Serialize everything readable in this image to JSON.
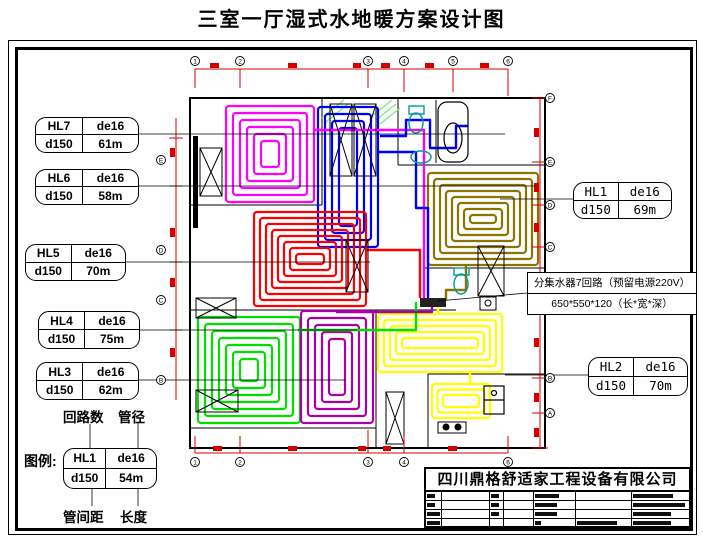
{
  "title": "三室一厅湿式水地暖方案设计图",
  "company": "四川鼎格舒适家工程设备有限公司",
  "labels": {
    "hl7": {
      "circuit": "HL7",
      "pipe": "de16",
      "spacing": "d150",
      "length": "61m"
    },
    "hl6": {
      "circuit": "HL6",
      "pipe": "de16",
      "spacing": "d150",
      "length": "58m"
    },
    "hl5": {
      "circuit": "HL5",
      "pipe": "de16",
      "spacing": "d150",
      "length": "70m"
    },
    "hl4": {
      "circuit": "HL4",
      "pipe": "de16",
      "spacing": "d150",
      "length": "75m"
    },
    "hl3": {
      "circuit": "HL3",
      "pipe": "de16",
      "spacing": "d150",
      "length": "62m"
    },
    "hl1": {
      "circuit": "HL1",
      "pipe": "de16",
      "spacing": "d150",
      "length": "69m"
    },
    "hl2": {
      "circuit": "HL2",
      "pipe": "de16",
      "spacing": "d150",
      "length": "70m"
    },
    "legend_sample": {
      "circuit": "HL1",
      "pipe": "de16",
      "spacing": "d150",
      "length": "54m"
    }
  },
  "manifold": {
    "line1": "分集水器7回路（预留电源220V）",
    "line2": "650*550*120（长*宽*深）"
  },
  "legend": {
    "title": "图例:",
    "top_labels": [
      "回路数",
      "管径"
    ],
    "bottom_labels": [
      "管间距",
      "长度"
    ]
  },
  "plan": {
    "loops": [
      {
        "name": "loop-hl7-bedroom-top-left",
        "color": "#FF00FF",
        "x": 226,
        "y": 106,
        "w": 88,
        "h": 96,
        "step": 7
      },
      {
        "name": "loop-hl6-hall-top",
        "color": "#0000FF",
        "x": 318,
        "y": 107,
        "w": 60,
        "h": 140,
        "step": 7
      },
      {
        "name": "loop-hl1-bedroom-right",
        "color": "#8B7500",
        "x": 428,
        "y": 173,
        "w": 110,
        "h": 92,
        "step": 6
      },
      {
        "name": "loop-hl5-living",
        "color": "#FF0000",
        "x": 254,
        "y": 212,
        "w": 112,
        "h": 94,
        "step": 6
      },
      {
        "name": "loop-hl4-bedroom-bottom-left",
        "color": "#00E000",
        "x": 198,
        "y": 317,
        "w": 102,
        "h": 106,
        "step": 7
      },
      {
        "name": "loop-hl3-bedroom-bottom-mid",
        "color": "#AA00AA",
        "x": 301,
        "y": 311,
        "w": 72,
        "h": 112,
        "step": 7
      },
      {
        "name": "loop-hl2-dining",
        "color": "#FFFF00",
        "x": 378,
        "y": 314,
        "w": 124,
        "h": 58,
        "step": 6
      },
      {
        "name": "loop-hl2-kitchen",
        "color": "#FFFF00",
        "x": 432,
        "y": 384,
        "w": 58,
        "h": 34,
        "step": 5.5
      }
    ],
    "pipes": [
      {
        "name": "trunk-magenta",
        "color": "#FF00FF",
        "points": "314,130 424,130 424,298"
      },
      {
        "name": "trunk-blue",
        "color": "#0000FF",
        "points": "378,152 416,152 416,208 428,208 428,298"
      },
      {
        "name": "branch-blue-bath",
        "color": "#0000FF",
        "points": "380,136 406,136 406,120 430,120 430,148 456,148 456,126 468,126"
      },
      {
        "name": "trunk-red",
        "color": "#FF0000",
        "points": "366,250 420,250 420,298"
      },
      {
        "name": "trunk-green",
        "color": "#00E000",
        "points": "298,330 416,330 416,302"
      },
      {
        "name": "trunk-purple",
        "color": "#AA00AA",
        "points": "336,312 432,312 432,302"
      },
      {
        "name": "trunk-yellow",
        "color": "#FFFF00",
        "points": "438,315 438,302"
      },
      {
        "name": "branch-yellow-kitchen",
        "color": "#FFFF00",
        "points": "470,372 470,384"
      },
      {
        "name": "trunk-olive",
        "color": "#8B7500",
        "points": "466,264 466,290 446,290 446,300"
      }
    ],
    "axes": {
      "top": {
        "y": 61,
        "labels": [
          {
            "x": 195,
            "n": "1"
          },
          {
            "x": 240,
            "n": "2"
          },
          {
            "x": 368,
            "n": "3"
          },
          {
            "x": 404,
            "n": "4"
          },
          {
            "x": 453,
            "n": "5"
          },
          {
            "x": 508,
            "n": "6"
          }
        ]
      },
      "bottom": {
        "y": 462,
        "labels": [
          {
            "x": 195,
            "n": "1"
          },
          {
            "x": 240,
            "n": "2"
          },
          {
            "x": 368,
            "n": "3"
          },
          {
            "x": 404,
            "n": "4"
          },
          {
            "x": 508,
            "n": "6"
          }
        ]
      },
      "right": {
        "x": 550,
        "labels": [
          {
            "y": 98,
            "n": "F"
          },
          {
            "y": 162,
            "n": "E"
          },
          {
            "y": 205,
            "n": "D"
          },
          {
            "y": 247,
            "n": "C"
          },
          {
            "y": 378,
            "n": "B"
          },
          {
            "y": 413,
            "n": "A"
          }
        ]
      },
      "left": {
        "x": 161,
        "labels": [
          {
            "y": 160,
            "n": "E"
          },
          {
            "y": 250,
            "n": "D"
          },
          {
            "y": 300,
            "n": "C"
          },
          {
            "y": 380,
            "n": "B"
          }
        ]
      }
    }
  }
}
